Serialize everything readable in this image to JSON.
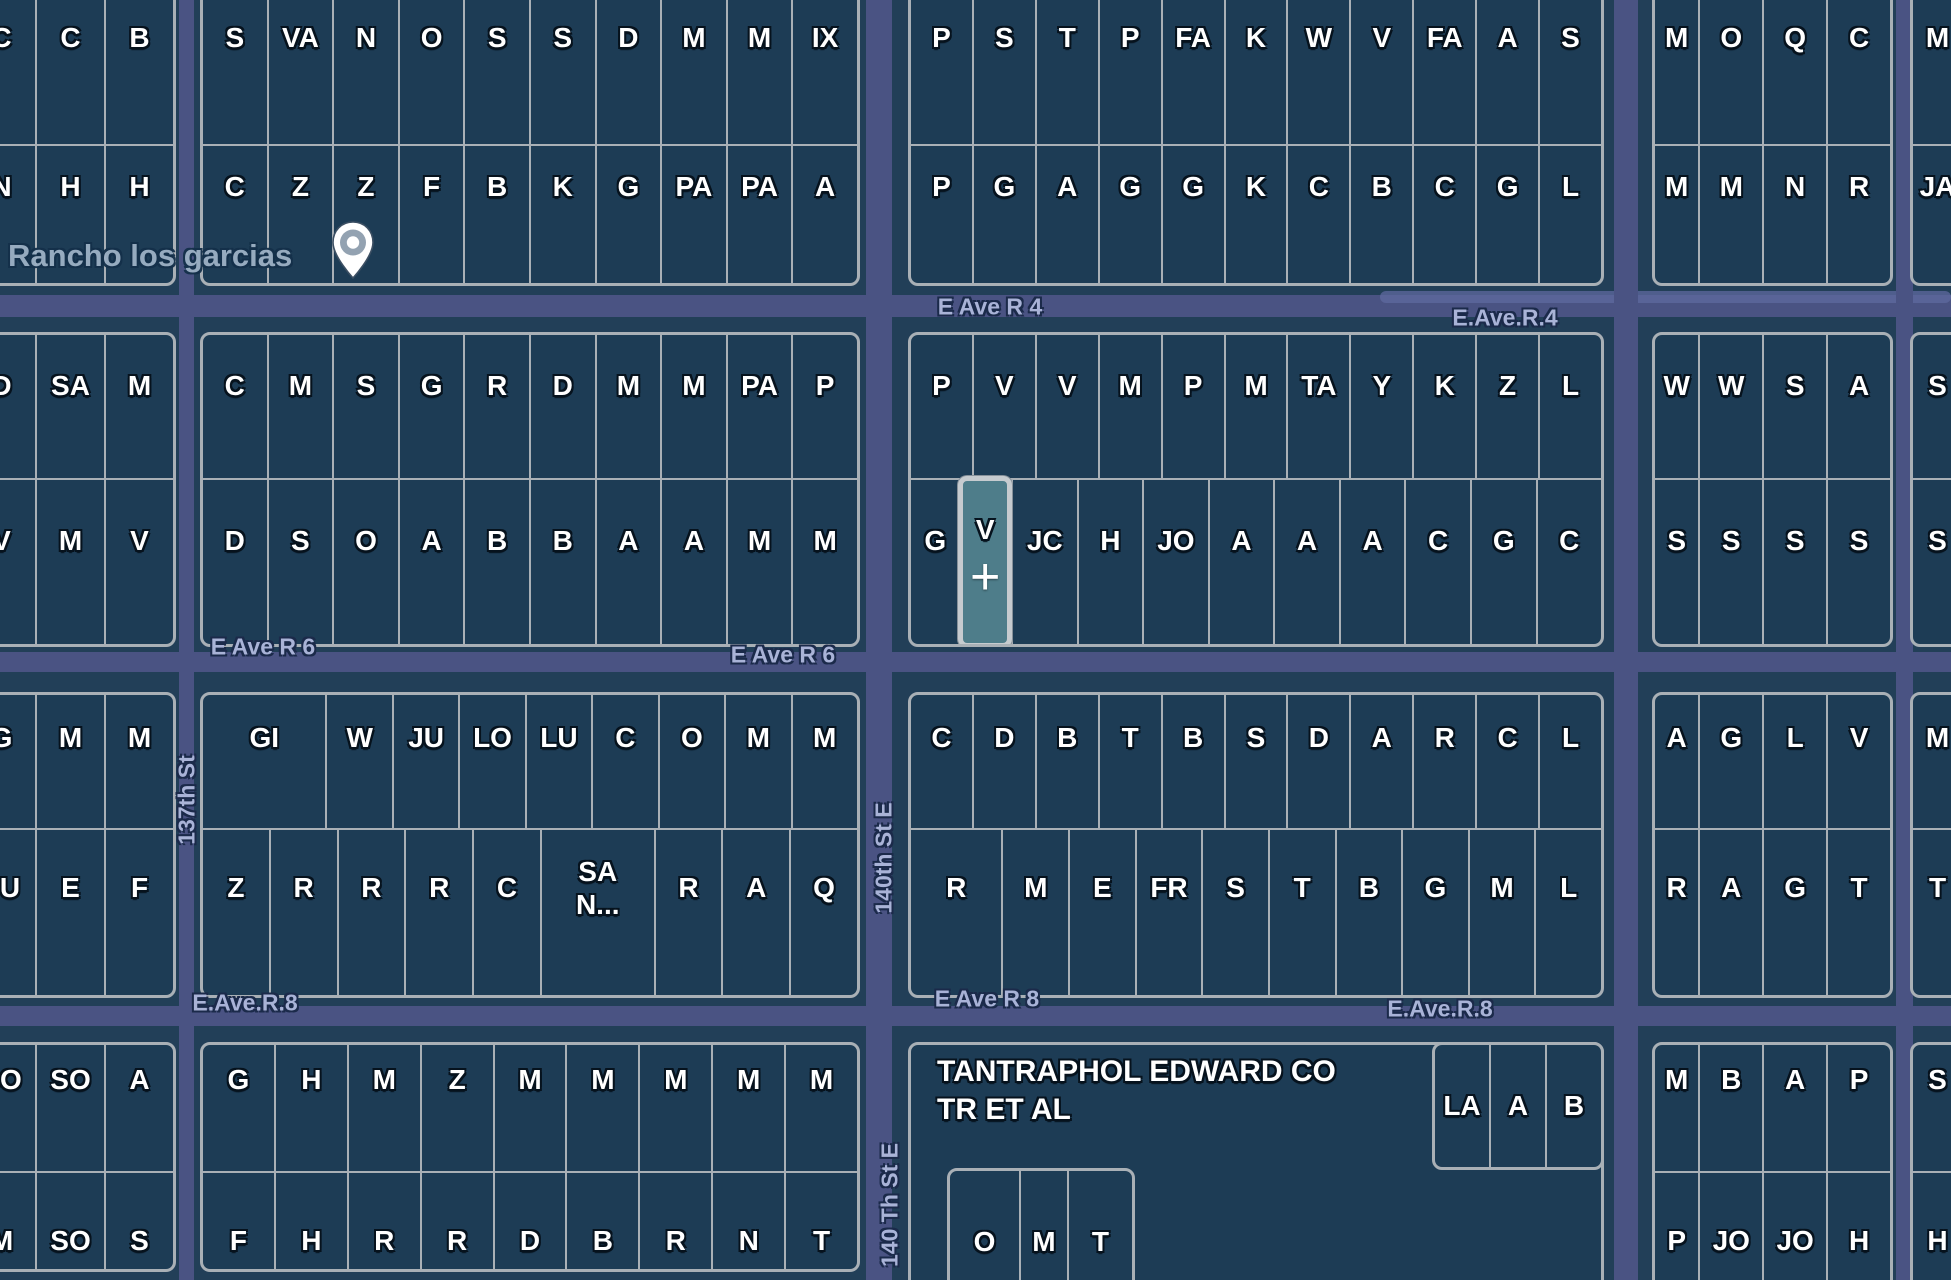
{
  "map": {
    "pin_label": "Rancho los garcias",
    "center_marker": "+",
    "colors": {
      "background": "#223f58",
      "parcel_fill": "#1d3c55",
      "parcel_border": "#a9b0b6",
      "road": "#4a5383",
      "road_light": "#5f699f",
      "road_text": "#a9b3d7",
      "parcel_text": "#ffffff",
      "selected_fill": "#4e7d8a",
      "selected_border": "#c6cbcf",
      "place_text": "#9db1c5"
    },
    "roads": [
      {
        "dir": "h",
        "x": 0,
        "y": 295,
        "w": 1951,
        "h": 22
      },
      {
        "dir": "h",
        "x": 1380,
        "y": 291,
        "w": 571,
        "h": 12,
        "light": true
      },
      {
        "dir": "h",
        "x": 0,
        "y": 652,
        "w": 1951,
        "h": 20
      },
      {
        "dir": "h",
        "x": 0,
        "y": 1006,
        "w": 1951,
        "h": 20
      },
      {
        "dir": "v",
        "x": 179,
        "y": 0,
        "w": 15,
        "h": 1280
      },
      {
        "dir": "v",
        "x": 866,
        "y": 0,
        "w": 26,
        "h": 1280
      },
      {
        "dir": "v",
        "x": 1614,
        "y": 0,
        "w": 24,
        "h": 1280
      },
      {
        "dir": "v",
        "x": 1896,
        "y": 0,
        "w": 17,
        "h": 1280
      }
    ],
    "road_labels": [
      {
        "t": "E Ave R 4",
        "x": 990,
        "y": 307
      },
      {
        "t": "E.Ave.R.4",
        "x": 1505,
        "y": 318
      },
      {
        "t": "E Ave R 6",
        "x": 263,
        "y": 647
      },
      {
        "t": "E Ave R 6",
        "x": 783,
        "y": 655
      },
      {
        "t": "E.Ave.R.8",
        "x": 245,
        "y": 1003
      },
      {
        "t": "E Ave R 8",
        "x": 987,
        "y": 999
      },
      {
        "t": "E.Ave.R.8",
        "x": 1440,
        "y": 1009
      },
      {
        "t": "137th St",
        "x": 187,
        "y": 800,
        "rot": true
      },
      {
        "t": "140th St E",
        "x": 884,
        "y": 858,
        "rot": true
      },
      {
        "t": "140 Th St E",
        "x": 890,
        "y": 1205,
        "rot": true
      }
    ],
    "blocks": [
      {
        "id": "A1",
        "x": -35,
        "y": -20,
        "w": 211,
        "h": 306,
        "rows": [
          {
            "h": 161,
            "dy": -25,
            "parcels": [
              "C",
              "C",
              "B"
            ]
          },
          {
            "dy": -27,
            "parcels": [
              "N",
              "H",
              "H"
            ]
          }
        ]
      },
      {
        "id": "B1",
        "x": 200,
        "y": -20,
        "w": 660,
        "h": 306,
        "rows": [
          {
            "h": 161,
            "dy": -25,
            "parcels": [
              "S",
              "VA",
              "N",
              "O",
              "S",
              "S",
              "D",
              "M",
              "M",
              "IX"
            ]
          },
          {
            "dy": -27,
            "parcels": [
              "C",
              "Z",
              "Z",
              "F",
              "B",
              "K",
              "G",
              "PA",
              "PA",
              "A"
            ]
          }
        ]
      },
      {
        "id": "C1",
        "x": 908,
        "y": -20,
        "w": 696,
        "h": 306,
        "rows": [
          {
            "h": 161,
            "dy": -25,
            "parcels": [
              "P",
              "S",
              "T",
              "P",
              "FA",
              "K",
              "W",
              "V",
              "FA",
              "A",
              "S"
            ]
          },
          {
            "dy": -27,
            "parcels": [
              "P",
              "G",
              "A",
              "G",
              "G",
              "K",
              "C",
              "B",
              "C",
              "G",
              "L"
            ]
          }
        ]
      },
      {
        "id": "D1",
        "x": 1652,
        "y": -20,
        "w": 241,
        "h": 306,
        "rows": [
          {
            "h": 161,
            "dy": -25,
            "parcels": [
              {
                "t": "M",
                "f": 0.7
              },
              "O",
              "Q",
              "C"
            ]
          },
          {
            "dy": -27,
            "parcels": [
              {
                "t": "M",
                "f": 0.7
              },
              "M",
              "N",
              "R"
            ]
          }
        ]
      },
      {
        "id": "E1",
        "x": 1910,
        "y": -20,
        "w": 55,
        "h": 306,
        "rows": [
          {
            "h": 161,
            "dy": -25,
            "parcels": [
              "M"
            ]
          },
          {
            "dy": -27,
            "parcels": [
              "JA"
            ]
          }
        ]
      },
      {
        "id": "A2",
        "x": -35,
        "y": 332,
        "w": 211,
        "h": 315,
        "rows": [
          {
            "h": 143,
            "dy": -20,
            "parcels": [
              "D",
              "SA",
              "M"
            ]
          },
          {
            "dy": -21,
            "parcels": [
              "V",
              "M",
              "V"
            ]
          }
        ]
      },
      {
        "id": "B2",
        "x": 200,
        "y": 332,
        "w": 660,
        "h": 315,
        "rows": [
          {
            "h": 143,
            "dy": -20,
            "parcels": [
              "C",
              "M",
              "S",
              "G",
              "R",
              "D",
              "M",
              "M",
              "PA",
              "P"
            ]
          },
          {
            "dy": -21,
            "parcels": [
              "D",
              "S",
              "O",
              "A",
              "B",
              "B",
              "A",
              "A",
              "M",
              "M"
            ]
          }
        ]
      },
      {
        "id": "C2",
        "x": 908,
        "y": 332,
        "w": 696,
        "h": 315,
        "rows": [
          {
            "h": 143,
            "dy": -20,
            "parcels": [
              "P",
              "V",
              "V",
              "M",
              "P",
              "M",
              "TA",
              "Y",
              "K",
              "Z",
              "L"
            ]
          },
          {
            "dy": -21,
            "parcels": [
              {
                "t": "G",
                "f": 0.8
              },
              {
                "t": "V",
                "f": 0.72,
                "sel": true
              },
              {
                "t": "JC",
                "f": 1.05
              },
              {
                "t": "H",
                "f": 1.05
              },
              {
                "t": "JO",
                "f": 1.05
              },
              {
                "t": "A",
                "f": 1.05
              },
              {
                "t": "A",
                "f": 1.05
              },
              {
                "t": "A",
                "f": 1.05
              },
              {
                "t": "C",
                "f": 1.05
              },
              {
                "t": "G",
                "f": 1.05
              },
              {
                "t": "C",
                "f": 1.05
              }
            ]
          }
        ]
      },
      {
        "id": "D2",
        "x": 1652,
        "y": 332,
        "w": 241,
        "h": 315,
        "rows": [
          {
            "h": 143,
            "dy": -20,
            "parcels": [
              {
                "t": "W",
                "f": 0.7
              },
              "W",
              "S",
              "A"
            ]
          },
          {
            "dy": -21,
            "parcels": [
              {
                "t": "S",
                "f": 0.7
              },
              "S",
              "S",
              "S"
            ]
          }
        ]
      },
      {
        "id": "E2",
        "x": 1910,
        "y": 332,
        "w": 55,
        "h": 315,
        "rows": [
          {
            "h": 143,
            "dy": -20,
            "parcels": [
              "S"
            ]
          },
          {
            "dy": -21,
            "parcels": [
              "S"
            ]
          }
        ]
      },
      {
        "id": "A3",
        "x": -35,
        "y": 692,
        "w": 211,
        "h": 306,
        "rows": [
          {
            "h": 133,
            "dy": -23,
            "parcels": [
              "G",
              "M",
              "M"
            ]
          },
          {
            "dy": -24,
            "parcels": [
              "FU",
              "E",
              "F"
            ]
          }
        ]
      },
      {
        "id": "B3",
        "x": 200,
        "y": 692,
        "w": 660,
        "h": 306,
        "rows": [
          {
            "h": 133,
            "dy": -23,
            "parcels": [
              {
                "t": "GI",
                "f": 1.9
              },
              "W",
              "JU",
              "LO",
              "LU",
              "C",
              "O",
              "M",
              "M"
            ]
          },
          {
            "dy": -24,
            "parcels": [
              "Z",
              "R",
              "R",
              "R",
              "C",
              {
                "t": "SA\nN...",
                "f": 1.7
              },
              "R",
              "A",
              "Q"
            ]
          }
        ]
      },
      {
        "id": "C3",
        "x": 908,
        "y": 692,
        "w": 696,
        "h": 306,
        "rows": [
          {
            "h": 133,
            "dy": -23,
            "parcels": [
              "C",
              "D",
              "B",
              "T",
              "B",
              "S",
              "D",
              "A",
              "R",
              "C",
              "L"
            ]
          },
          {
            "dy": -24,
            "parcels": [
              {
                "t": "R",
                "f": 1.4
              },
              "M",
              "E",
              "FR",
              "S",
              "T",
              "B",
              "G",
              "M",
              "L"
            ]
          }
        ]
      },
      {
        "id": "D3",
        "x": 1652,
        "y": 692,
        "w": 241,
        "h": 306,
        "rows": [
          {
            "h": 133,
            "dy": -23,
            "parcels": [
              {
                "t": "A",
                "f": 0.7
              },
              "G",
              "L",
              "V"
            ]
          },
          {
            "dy": -24,
            "parcels": [
              {
                "t": "R",
                "f": 0.7
              },
              "A",
              "G",
              "T"
            ]
          }
        ]
      },
      {
        "id": "E3",
        "x": 1910,
        "y": 692,
        "w": 55,
        "h": 306,
        "rows": [
          {
            "h": 133,
            "dy": -23,
            "parcels": [
              "M"
            ]
          },
          {
            "dy": -24,
            "parcels": [
              "T"
            ]
          }
        ]
      },
      {
        "id": "A4",
        "x": -35,
        "y": 1042,
        "w": 211,
        "h": 230,
        "rows": [
          {
            "h": 126,
            "dy": -28,
            "parcels": [
              "SO",
              "SO",
              "A"
            ]
          },
          {
            "dy": 20,
            "parcels": [
              "M",
              "SO",
              "S"
            ]
          }
        ]
      },
      {
        "id": "B4",
        "x": 200,
        "y": 1042,
        "w": 660,
        "h": 230,
        "rows": [
          {
            "h": 126,
            "dy": -28,
            "parcels": [
              "G",
              "H",
              "M",
              "Z",
              "M",
              "M",
              "M",
              "M",
              "M"
            ]
          },
          {
            "dy": 20,
            "parcels": [
              "F",
              "H",
              "R",
              "R",
              "D",
              "B",
              "R",
              "N",
              "T"
            ]
          }
        ]
      },
      {
        "id": "C4",
        "x": 908,
        "y": 1042,
        "w": 696,
        "h": 290,
        "rows": [],
        "labels": [
          {
            "t": "TANTRAPHOL EDWARD CO TR ET AL",
            "x": 26,
            "y": 8,
            "w": 440
          }
        ]
      },
      {
        "id": "C4strip",
        "x": 1432,
        "y": 1042,
        "w": 172,
        "h": 128,
        "rows": [
          {
            "dy": 0,
            "parcels": [
              "LA",
              "A",
              "B"
            ]
          }
        ]
      },
      {
        "id": "OMT",
        "x": 947,
        "y": 1168,
        "w": 188,
        "h": 164,
        "rows": [
          {
            "dy": -8,
            "parcels": [
              {
                "t": "O",
                "f": 1.2
              },
              {
                "t": "M",
                "f": 0.8
              },
              {
                "t": "T",
                "f": 1.1
              }
            ]
          }
        ]
      },
      {
        "id": "D4",
        "x": 1652,
        "y": 1042,
        "w": 241,
        "h": 290,
        "rows": [
          {
            "h": 126,
            "dy": -28,
            "parcels": [
              {
                "t": "M",
                "f": 0.7
              },
              "B",
              "A",
              "P"
            ]
          },
          {
            "dy": -10,
            "parcels": [
              {
                "t": "P",
                "f": 0.7
              },
              "JO",
              "JO",
              "H"
            ]
          }
        ]
      },
      {
        "id": "E4",
        "x": 1910,
        "y": 1042,
        "w": 55,
        "h": 290,
        "rows": [
          {
            "h": 126,
            "dy": -28,
            "parcels": [
              "S"
            ]
          },
          {
            "dy": -10,
            "parcels": [
              "H"
            ]
          }
        ]
      }
    ]
  }
}
